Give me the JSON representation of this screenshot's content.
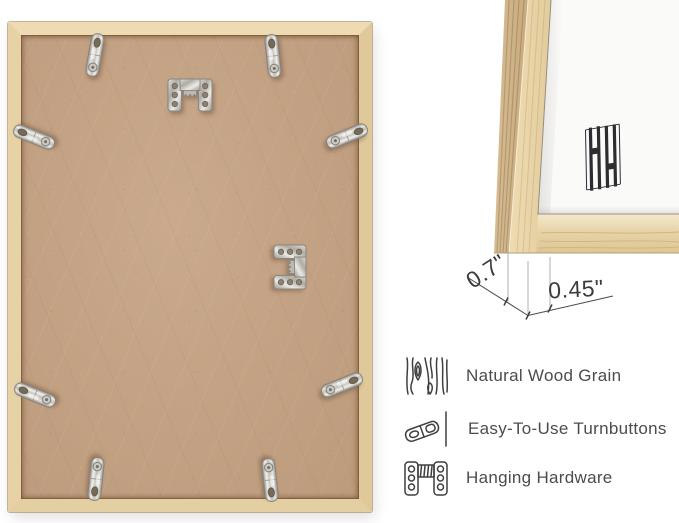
{
  "product_view": {
    "left_photo": "frame-back-with-hardware",
    "right_photo": "frame-corner-front-detail"
  },
  "brand_mark": {
    "icon": "double-h-monogram-icon"
  },
  "dimensions": {
    "depth_label": "0.7\"",
    "face_label": "0.45\""
  },
  "features": {
    "items": [
      {
        "icon": "wood-grain-icon",
        "label": "Natural Wood Grain"
      },
      {
        "icon": "turnbutton-icon",
        "label": "Easy-To-Use Turnbuttons"
      },
      {
        "icon": "hanging-hardware-icon",
        "label": "Hanging Hardware"
      }
    ]
  },
  "hardware": {
    "turnbutton_count": 8,
    "sawtooth_hanger_count": 2
  },
  "colors": {
    "frame_wood": "#e7d2a6",
    "backing_board": "#c4a284",
    "metal_hardware": "#c9c6c0",
    "mat": "#fafaf9",
    "annotation_text": "#3b3b3b",
    "feature_text": "#4c4c4c",
    "logo_ink": "#2d2d31"
  }
}
